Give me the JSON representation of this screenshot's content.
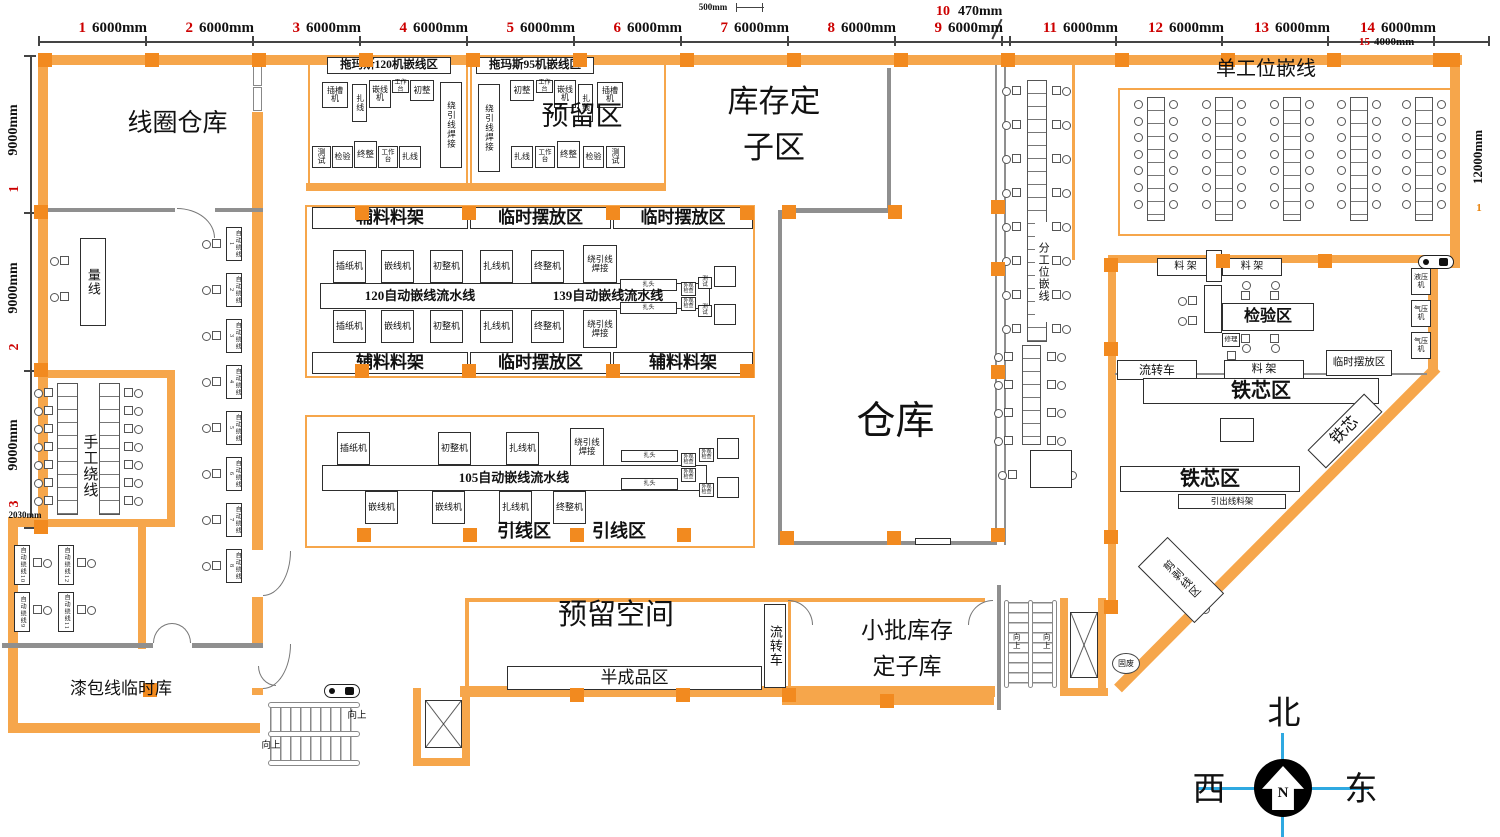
{
  "dims": {
    "top": [
      {
        "no": "1",
        "len": "6000mm"
      },
      {
        "no": "2",
        "len": "6000mm"
      },
      {
        "no": "3",
        "len": "6000mm"
      },
      {
        "no": "4",
        "len": "6000mm"
      },
      {
        "no": "5",
        "len": "6000mm"
      },
      {
        "no": "6",
        "len": "6000mm"
      },
      {
        "no": "7",
        "len": "6000mm"
      },
      {
        "no": "8",
        "len": "6000mm"
      },
      {
        "no": "9",
        "len": "6000mm"
      },
      {
        "no": "10",
        "len": "470mm"
      },
      {
        "no": "11",
        "len": "6000mm"
      },
      {
        "no": "12",
        "len": "6000mm"
      },
      {
        "no": "13",
        "len": "6000mm"
      },
      {
        "no": "14",
        "len": "6000mm"
      },
      {
        "no": "15",
        "len": "4000mm"
      }
    ],
    "small_top": "500mm",
    "left": [
      {
        "no": "1",
        "len": "9000mm"
      },
      {
        "no": "2",
        "len": "9000mm"
      },
      {
        "no": "3",
        "len": "9000mm"
      }
    ],
    "small_left": "2030mm",
    "right": {
      "no": "1",
      "len": "12000mm"
    }
  },
  "areas": {
    "coil_wh": "线圈仓库",
    "measure": "量线",
    "manual_wind": "手工绕线",
    "enamel_tmp": "漆包线临时库",
    "thomas120": "拖玛斯120机嵌线区",
    "thomas95": "拖玛斯95机嵌线区",
    "reserved": "预留区",
    "stock1": "库存定",
    "stock2": "子区",
    "wh": "仓库",
    "split": "分工位嵌线",
    "single": "单工位嵌线",
    "aux": "辅料料架",
    "tmp": "临时摆放区",
    "line120": "120自动嵌线流水线",
    "line139": "139自动嵌线流水线",
    "line105": "105自动嵌线流水线",
    "lead": "引线区",
    "space": "预留空间",
    "semi": "半成品区",
    "cart": "流转车",
    "batch1": "小批库存",
    "batch2": "定子库",
    "rack": "料 架",
    "inspect": "检验区",
    "repair": "修理",
    "hyd": "液压机",
    "pneu": "气压机",
    "core_zone": "铁芯区",
    "core": "铁芯",
    "lead_rack": "引出线料架",
    "strip": "剪剥线区",
    "waste": "固废",
    "up": "向上"
  },
  "machines": {
    "slot": "插槽机",
    "tie": "扎线",
    "insertm": "嵌线机",
    "bench": "工作台",
    "pre": "初整",
    "weld": "绕引线焊接",
    "test": "测试",
    "check": "检验",
    "fin": "终整",
    "paper": "插纸机",
    "prem": "初整机",
    "tiem": "扎线机",
    "finm": "终整机",
    "head": "扎头",
    "visual": "外观检查"
  },
  "stations": [
    "自动绕线1",
    "自动绕线2",
    "自动绕线3",
    "自动绕线4",
    "自动绕线5",
    "自动绕线6",
    "自动绕线7",
    "自动绕线8",
    "自动绕线9",
    "自动绕线10",
    "自动绕线11",
    "自动绕线12"
  ],
  "compass": {
    "n": "北",
    "w": "西",
    "e": "东",
    "letter": "N"
  }
}
